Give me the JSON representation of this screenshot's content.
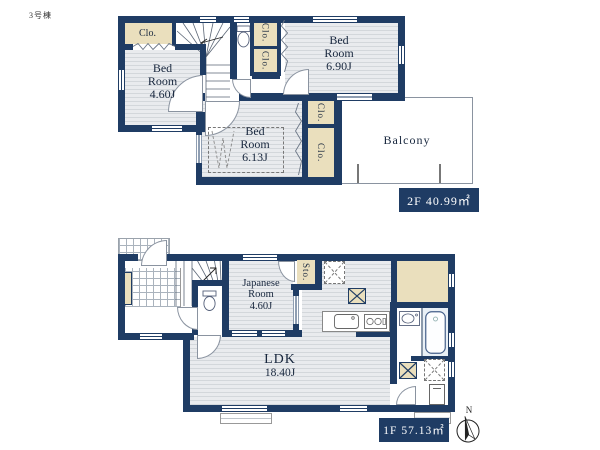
{
  "building_label": "3号棟",
  "colors": {
    "wall": "#1f3c64",
    "floor": "#e9ebee",
    "floor_line": "#d3d7db",
    "closet": "#eadfbd",
    "text": "#17263d",
    "label_text": "#ffffff",
    "bath": "#e9f0f6",
    "grid_line": "#aab3bd"
  },
  "floor2": {
    "area_label": "2F 40.99㎡",
    "closet_nw": "Clo.",
    "closet_mid_1": "Clo.",
    "closet_mid_2": "Clo.",
    "closet_e_1": "Clo.",
    "closet_e_2": "Clo.",
    "bedroom_a": {
      "line1": "Bed",
      "line2": "Room",
      "line3": "4.60J"
    },
    "bedroom_b": {
      "line1": "Bed",
      "line2": "Room",
      "line3": "6.90J"
    },
    "bedroom_c": {
      "line1": "Bed",
      "line2": "Room",
      "line3": "6.13J"
    },
    "balcony": "Balcony"
  },
  "floor1": {
    "area_label": "1F 57.13㎡",
    "japanese_room": {
      "line1": "Japanese",
      "line2": "Room",
      "line3": "4.60J"
    },
    "storage": "Sto.",
    "ldk": {
      "line1": "LDK",
      "line2": "18.40J"
    },
    "compass_north": "N"
  }
}
